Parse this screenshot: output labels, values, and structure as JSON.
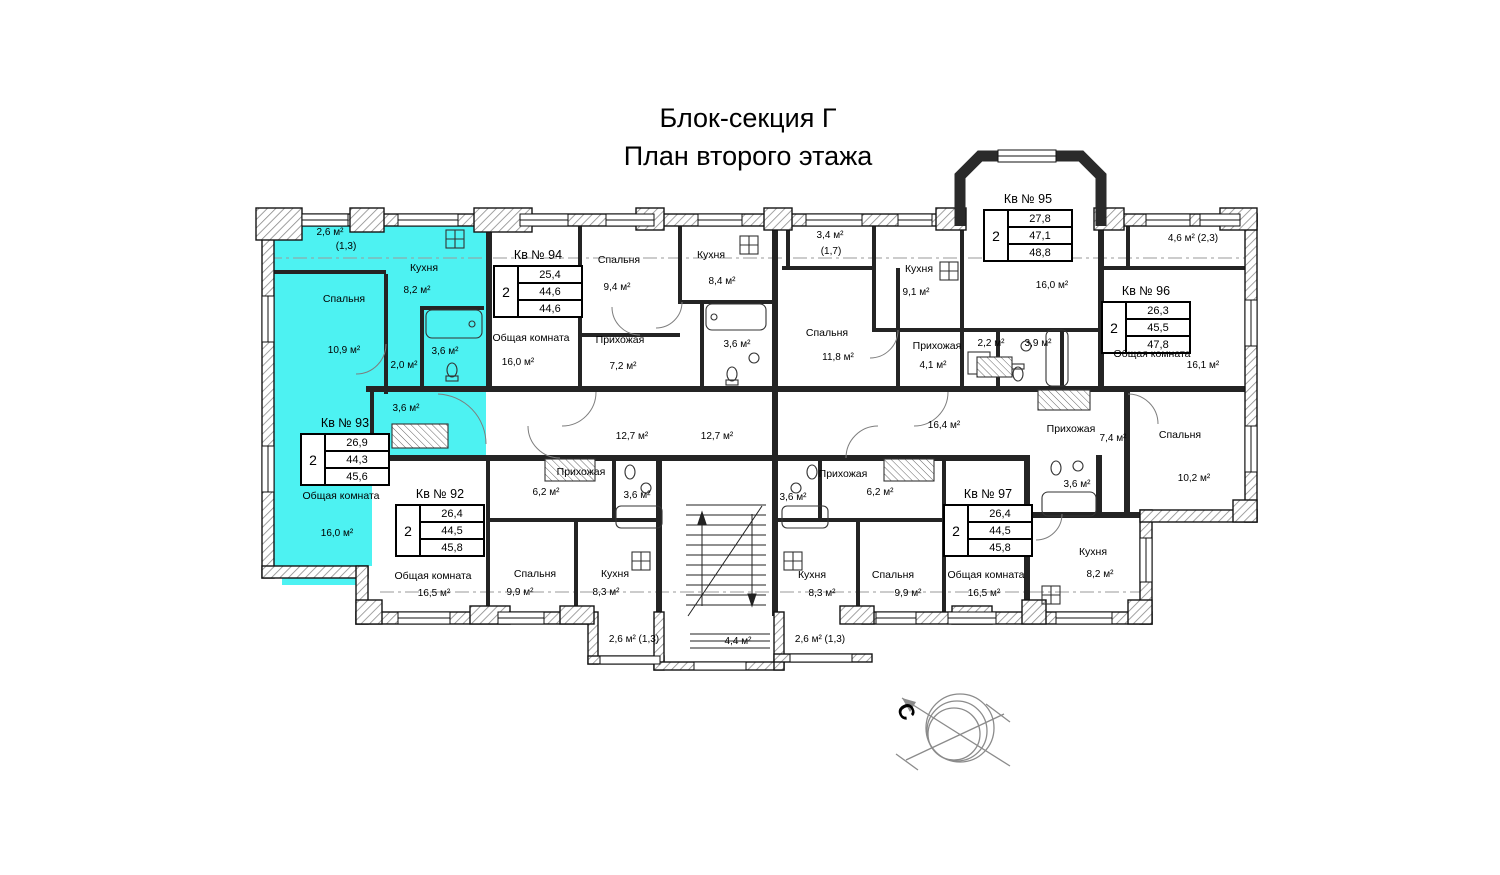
{
  "page_title": {
    "line1": "Блок-секция Г",
    "line2": "План второго этажа"
  },
  "compass": {
    "north_label": "С"
  },
  "highlight_color": "#4df2f2",
  "apartments": {
    "kv92": {
      "title": "Кв № 92",
      "rooms": "2",
      "areas": {
        "living": "26,4",
        "total": "44,5",
        "total_with_balcony": "45,8"
      }
    },
    "kv93": {
      "title": "Кв № 93",
      "rooms": "2",
      "areas": {
        "living": "26,9",
        "total": "44,3",
        "total_with_balcony": "45,6"
      }
    },
    "kv94": {
      "title": "Кв № 94",
      "rooms": "2",
      "areas": {
        "living": "25,4",
        "total": "44,6",
        "total_with_balcony": "44,6"
      }
    },
    "kv95": {
      "title": "Кв № 95",
      "rooms": "2",
      "areas": {
        "living": "27,8",
        "total": "47,1",
        "total_with_balcony": "48,8"
      }
    },
    "kv96": {
      "title": "Кв № 96",
      "rooms": "2",
      "areas": {
        "living": "26,3",
        "total": "45,5",
        "total_with_balcony": "47,8"
      }
    },
    "kv97": {
      "title": "Кв № 97",
      "rooms": "2",
      "areas": {
        "living": "26,4",
        "total": "44,5",
        "total_with_balcony": "45,8"
      }
    }
  },
  "labels": {
    "kv93_balc_a": "2,6 м²",
    "kv93_balc_b": "(1,3)",
    "kv93_kitchen": "Кухня",
    "kv93_kitchen_a": "8,2 м²",
    "kv93_bed": "Спальня",
    "kv93_bed_a": "10,9 м²",
    "kv93_bath_a": "3,6 м²",
    "kv93_hall_a": "2,0 м²",
    "kv93_corr_a": "3,6 м²",
    "kv93_living": "Общая комната",
    "kv93_living_a": "16,0 м²",
    "kv94_bed": "Спальня",
    "kv94_bed_a": "9,4 м²",
    "kv94_kitchen": "Кухня",
    "kv94_kitchen_a": "8,4 м²",
    "kv94_living": "Общая комната",
    "kv94_living_a": "16,0 м²",
    "kv94_hall": "Прихожая",
    "kv94_hall_a": "7,2 м²",
    "kv94_bath_a": "3,6 м²",
    "kv95_balc_a": "3,4 м²",
    "kv95_balc_b": "(1,7)",
    "kv95_kitchen": "Кухня",
    "kv95_kitchen_a": "9,1 м²",
    "kv95_bed": "Спальня",
    "kv95_bed_a": "11,8 м²",
    "kv95_living_a": "16,0 м²",
    "kv95_hall": "Прихожая",
    "kv95_hall_a": "4,1 м²",
    "kv95_wc_a": "2,2 м²",
    "kv95_bath_a": "3,9 м²",
    "kv96_balc_a": "4,6 м²  (2,3)",
    "kv96_living": "Общая комната",
    "kv96_living_a": "16,1 м²",
    "kv96_hall": "Прихожая",
    "kv96_hall_a": "7,4 м²",
    "kv96_bed": "Спальня",
    "kv96_bed_a": "10,2 м²",
    "kv96_bath_a": "3,6 м²",
    "kv96_kitchen": "Кухня",
    "kv96_kitchen_a": "8,2 м²",
    "corr_a": "12,7 м²",
    "corr_b": "12,7 м²",
    "corr_c": "16,4 м²",
    "kv92_hall": "Прихожая",
    "kv92_hall_a": "6,2 м²",
    "kv92_bath_a": "3,6 м²",
    "kv92_living": "Общая комната",
    "kv92_living_a": "16,5 м²",
    "kv92_bed": "Спальня",
    "kv92_bed_a": "9,9 м²",
    "kv92_kitchen": "Кухня",
    "kv92_kitchen_a": "8,3 м²",
    "balc_bl": "2,6 м² (1,3)",
    "stair_a": "4,4 м²",
    "balc_br": "2,6 м² (1,3)",
    "kv97_hall": "Прихожая",
    "kv97_hall_a": "6,2 м²",
    "kv97_bath_a": "3,6 м²",
    "kv97_kitchen": "Кухня",
    "kv97_kitchen_a": "8,3 м²",
    "kv97_bed": "Спальня",
    "kv97_bed_a": "9,9 м²",
    "kv97_living": "Общая комната",
    "kv97_living_a": "16,5 м²"
  }
}
